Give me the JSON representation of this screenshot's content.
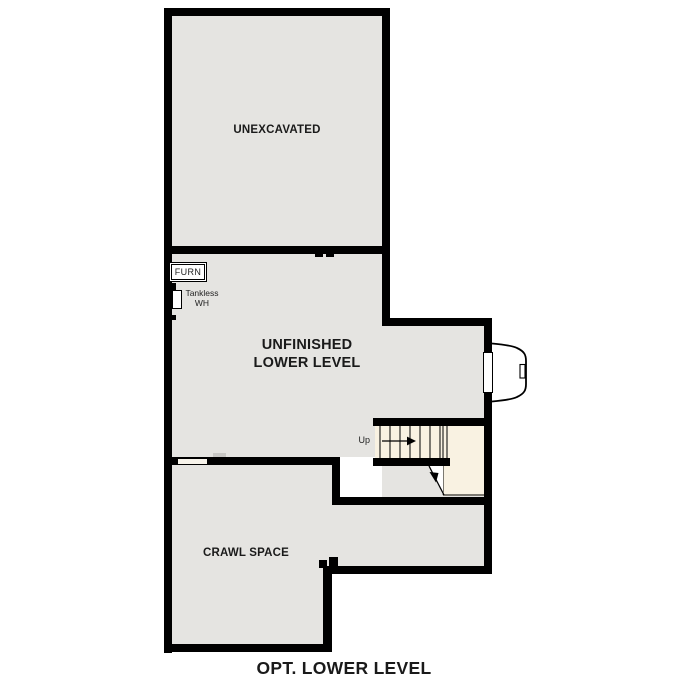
{
  "title": "OPT. LOWER LEVEL",
  "colors": {
    "wall": "#000000",
    "floor": "#e5e4e1",
    "stair": "#f9f2e2",
    "text": "#1a1a1a",
    "background": "#ffffff"
  },
  "rooms": {
    "unexcavated": {
      "label": "UNEXCAVATED"
    },
    "lower_level": {
      "line1": "UNFINISHED",
      "line2": "LOWER LEVEL"
    },
    "crawl_space": {
      "label": "CRAWL SPACE"
    }
  },
  "fixtures": {
    "furnace": {
      "label": "FURN"
    },
    "water_heater": {
      "line1": "Tankless",
      "line2": "WH"
    }
  },
  "stairs": {
    "direction_label": "Up",
    "tread_count": 8
  },
  "features": {
    "window_well": "egress-window-well",
    "crawl_access": "crawl-space-access-opening"
  }
}
